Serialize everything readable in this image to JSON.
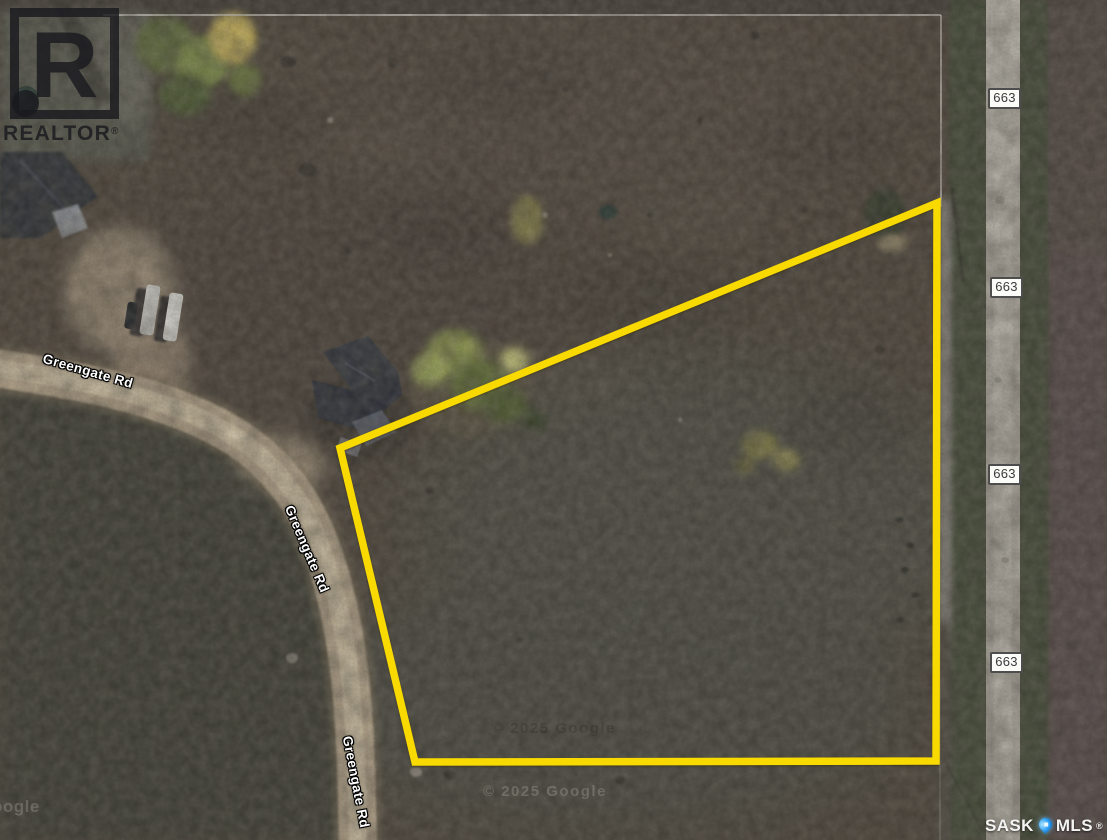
{
  "map": {
    "road_name": "Greengate Rd",
    "highway_number": "663"
  },
  "branding": {
    "realtor": {
      "letter": "R",
      "name": "REALTOR",
      "registered": "®"
    },
    "mls": {
      "left": "SASK",
      "right": "MLS",
      "registered": "®"
    }
  },
  "attribution": {
    "google_copyright": "© 2025 Google",
    "google_partial": "oogle"
  },
  "colors": {
    "property_boundary": "#f8da00",
    "mls_pin": "#2a9df4",
    "road_label_text": "#ffffff",
    "highway_shield_bg": "#fbfbf8"
  }
}
